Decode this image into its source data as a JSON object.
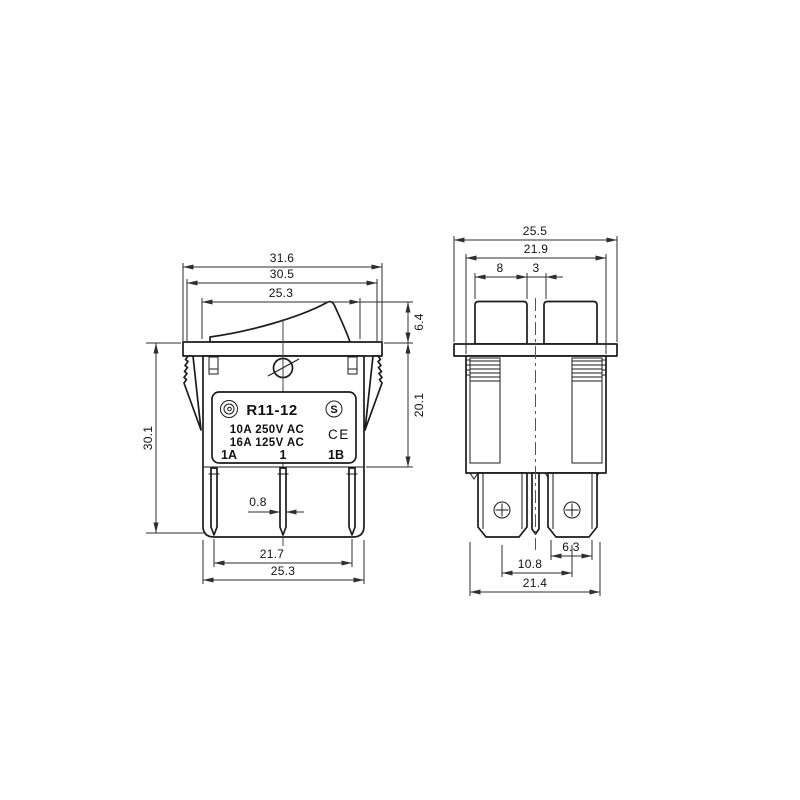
{
  "title": "Rocker switch R11-12 dimensional drawing",
  "colors": {
    "background": "#ffffff",
    "line": "#1b1b1b",
    "dim_line": "#2e2e2e",
    "text": "#111111"
  },
  "label_plate": {
    "model": "R11-12",
    "rating_line1": "10A 250V AC",
    "rating_line2": "16A 125V AC",
    "pole_left": "1A",
    "pole_center": "1",
    "pole_right": "1B",
    "s_mark": "S",
    "ce_mark": "CE"
  },
  "front_view": {
    "dims": {
      "flange_width": "31.6",
      "housing_width": "30.5",
      "rocker_width": "25.3",
      "rocker_height": "6.4",
      "body_height": "20.1",
      "overall_height": "30.1",
      "pin_thickness": "0.8",
      "pin_span": "21.7",
      "base_width": "25.3"
    }
  },
  "side_view": {
    "dims": {
      "flange_depth": "25.5",
      "housing_depth": "21.9",
      "rocker_segment": "8",
      "rocker_gap": "3",
      "pin_width": "6.3",
      "pin_pitch": "10.8",
      "base_depth": "21.4"
    }
  }
}
